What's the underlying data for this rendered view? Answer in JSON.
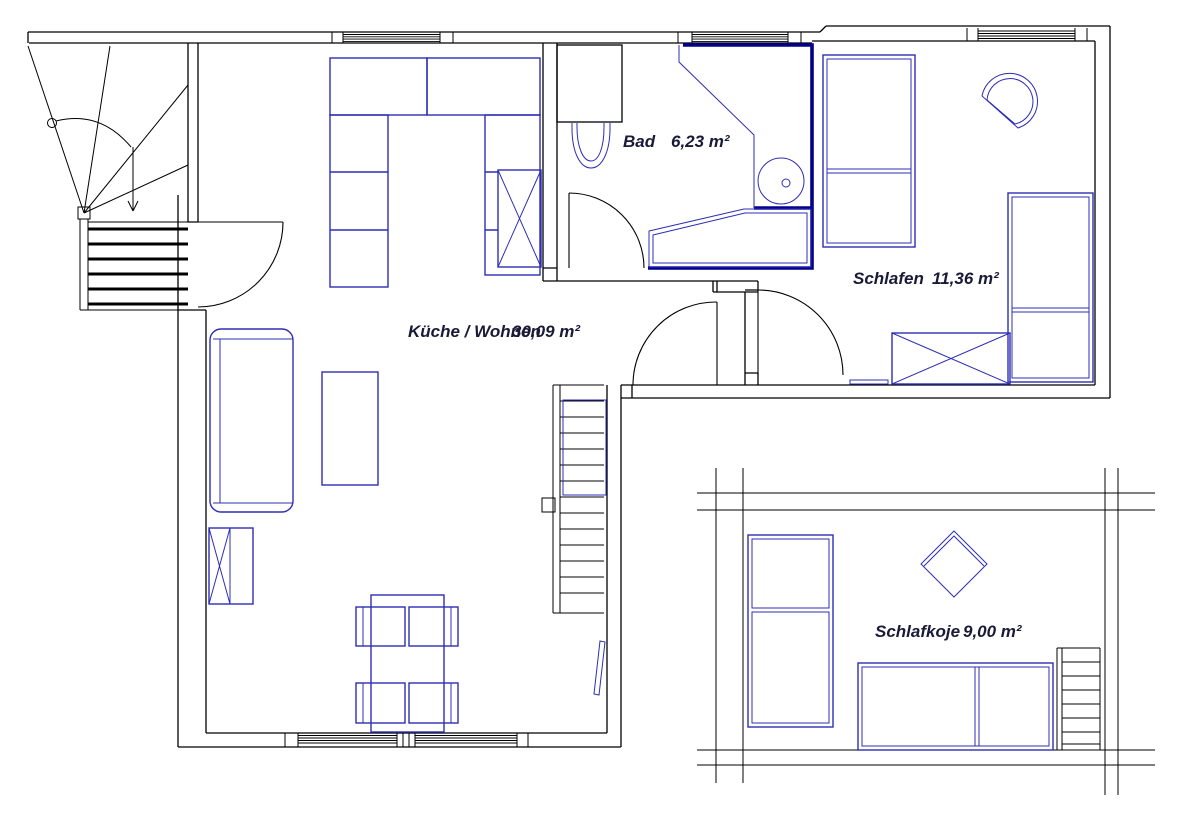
{
  "rooms": {
    "kueche_wohnen": {
      "name": "Küche / Wohnen",
      "area": "30,09 m²"
    },
    "bad": {
      "name": "Bad",
      "area": "6,23 m²"
    },
    "schlafen": {
      "name": "Schlafen",
      "area": "11,36 m²"
    },
    "schlafkoje": {
      "name": "Schlafkoje",
      "area": "9,00 m²"
    }
  },
  "colors": {
    "wall_line": "#000000",
    "furniture_line": "#2d2db4",
    "bath_wall": "#00008b",
    "label_text": "#1a1a38",
    "background": "#ffffff"
  }
}
